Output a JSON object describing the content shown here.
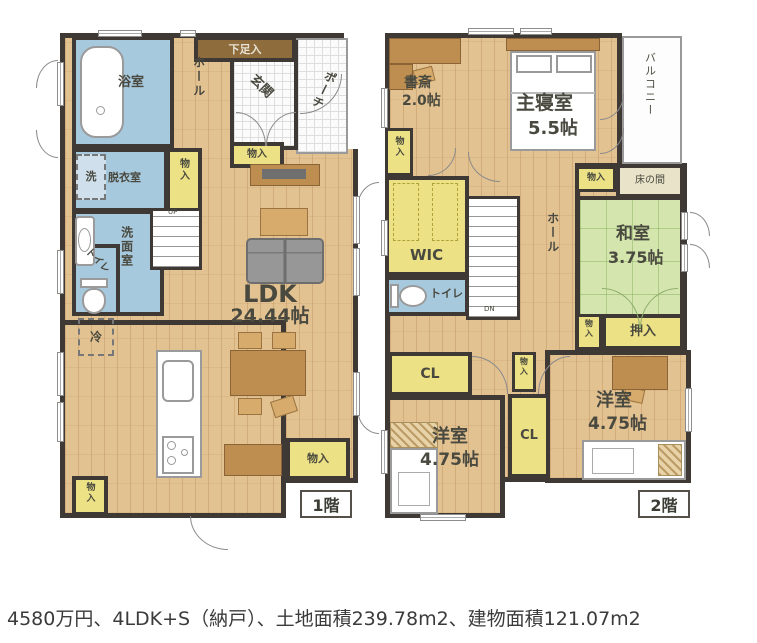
{
  "caption": "4580万円、4LDK+S（納戸）、土地面積239.78m2、建物面積121.07m2",
  "colors": {
    "wall": "#3e3934",
    "wood_floor": "#e3c292",
    "water_rooms_blue": "#a7c9de",
    "closet_yellow": "#ece185",
    "tatami_green": "#d4e6ae",
    "furniture_brown": "#bd8e50",
    "background": "#ffffff"
  },
  "floor1": {
    "label": "1階",
    "bathroom": "浴室",
    "hall": "ホール",
    "shoe_closet": "下足入",
    "entrance": "玄関",
    "porch": "ポーチ",
    "washer": "洗",
    "dressing_room": "脱衣室",
    "storage_dressing": "物入",
    "storage_entrance": "物入",
    "washroom": "洗面室",
    "toilet": "トイレ",
    "fridge": "冷",
    "up": "UP",
    "ldk_name": "LDK",
    "ldk_size": "24.44帖",
    "storage_ldk": "物入",
    "storage_kitchen": "物入"
  },
  "floor2": {
    "label": "2階",
    "study_name": "書斎",
    "study_size": "2.0帖",
    "master_name": "主寝室",
    "master_size": "5.5帖",
    "balcony": "バルコニー",
    "storage_study": "物入",
    "wic": "WIC",
    "toilet": "トイレ",
    "hall": "ホール",
    "dn": "DN",
    "storage_hall": "物入",
    "tokonoma": "床の間",
    "washitsu_name": "和室",
    "washitsu_size": "3.75帖",
    "storage_washitsu": "物入",
    "oshiire": "押入",
    "cl_north": "CL",
    "storage_center": "物入",
    "cl_center": "CL",
    "west_room1_name": "洋室",
    "west_room1_size": "4.75帖",
    "west_room2_name": "洋室",
    "west_room2_size": "4.75帖"
  }
}
